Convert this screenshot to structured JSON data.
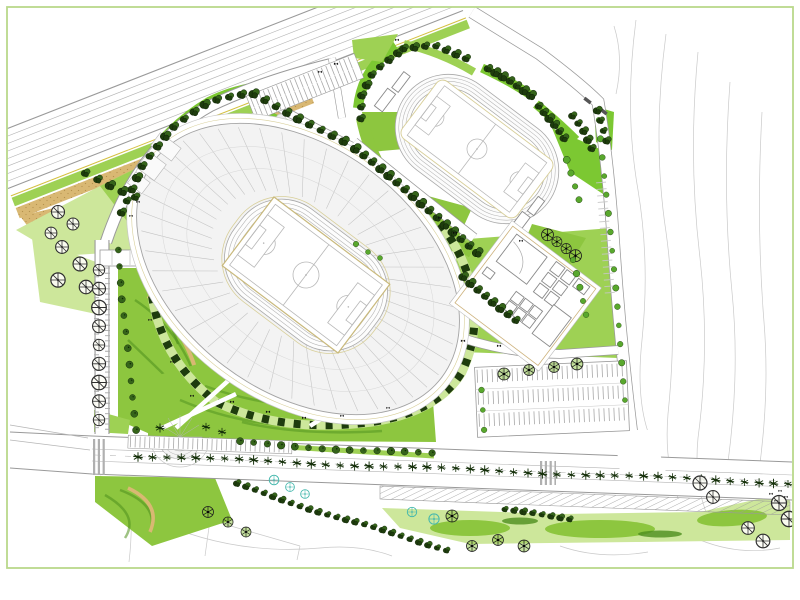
{
  "palette": {
    "paper": "#ffffff",
    "frame": "#b9d98b",
    "lawn_light": "#cde79b",
    "lawn_mid": "#9ed154",
    "lawn_bright": "#8dc63f",
    "lawn_vivid": "#7cc832",
    "grass_streak": "#4e8f1e",
    "tan": "#d9b873",
    "tan_dark": "#b5924e",
    "tan_line": "#d8cf9a",
    "road_edge": "#9a9a9a",
    "road_line": "#b5b5b5",
    "detail_gray": "#c7c7c7",
    "detail_faint": "#d6d6d6",
    "contour": "#c9c9c9",
    "stand_fill": "#f3f3f3",
    "pitch_border": "#c9b97c",
    "pitch_line": "#b8b8b8",
    "tree_dark": "#1e3c0d",
    "tree_mid": "#35641a",
    "tree_leaf": "#59a82d",
    "tree_cyan": "#45b8ad",
    "median_tree": "#15300a",
    "yellow_line": "#d4c040"
  },
  "stadium": {
    "center": [
      306,
      275
    ],
    "rotation": 37,
    "bowl_cx": -10,
    "sections": 44,
    "stand_inner": [
      96,
      66
    ],
    "stand_outer": [
      176,
      118
    ]
  },
  "track": {
    "center": [
      477,
      149
    ],
    "rotation": 37,
    "lanes": 6
  },
  "vegetation": {
    "rows": [
      {
        "name": "stadium-nw-road-trees",
        "type": "dark",
        "size": 4.4,
        "count": 24,
        "pts": [
          [
            122,
            212
          ],
          [
            142,
            164
          ],
          [
            172,
            128
          ],
          [
            210,
            102
          ],
          [
            252,
            92
          ],
          [
            300,
            118
          ],
          [
            344,
            141
          ]
        ]
      },
      {
        "name": "corridor-trees",
        "type": "dark",
        "size": 4.6,
        "count": 16,
        "pts": [
          [
            356,
            148
          ],
          [
            400,
            186
          ],
          [
            440,
            218
          ],
          [
            478,
            252
          ]
        ]
      },
      {
        "name": "track-nw-trees",
        "type": "dark",
        "size": 4.2,
        "count": 8,
        "pts": [
          [
            398,
            52
          ],
          [
            374,
            72
          ],
          [
            363,
            96
          ],
          [
            362,
            118
          ]
        ]
      },
      {
        "name": "track-n-trees",
        "type": "dark",
        "size": 4.1,
        "count": 7,
        "pts": [
          [
            404,
            47
          ],
          [
            434,
            45
          ],
          [
            466,
            59
          ]
        ]
      },
      {
        "name": "track-ne-trees",
        "type": "dark",
        "size": 4.5,
        "count": 7,
        "pts": [
          [
            488,
            69
          ],
          [
            510,
            80
          ],
          [
            532,
            94
          ]
        ]
      },
      {
        "name": "track-e-trees-1",
        "type": "dark",
        "size": 4.3,
        "count": 6,
        "pts": [
          [
            540,
            105
          ],
          [
            554,
            122
          ],
          [
            564,
            138
          ]
        ]
      },
      {
        "name": "track-e-trees-2",
        "type": "dark",
        "size": 4.1,
        "count": 5,
        "pts": [
          [
            572,
            116
          ],
          [
            584,
            132
          ],
          [
            592,
            148
          ]
        ]
      },
      {
        "name": "track-se-spoke-trees",
        "type": "spoke",
        "size": 5.5,
        "count": 4,
        "pts": [
          [
            548,
            234
          ],
          [
            562,
            244
          ],
          [
            576,
            255
          ]
        ]
      },
      {
        "name": "track-e-leaf-trees",
        "type": "leaf",
        "size": 4,
        "count": 4,
        "pts": [
          [
            566,
            160
          ],
          [
            572,
            180
          ],
          [
            578,
            200
          ]
        ]
      },
      {
        "name": "buildings-nw-trees",
        "type": "dark",
        "size": 4.4,
        "count": 8,
        "pts": [
          [
            464,
            276
          ],
          [
            490,
            298
          ],
          [
            516,
            320
          ]
        ]
      },
      {
        "name": "buildings-e-trees",
        "type": "leaf",
        "size": 3.8,
        "count": 5,
        "pts": [
          [
            573,
            260
          ],
          [
            585,
            315
          ]
        ]
      },
      {
        "name": "west-road-outline-trees",
        "type": "round",
        "size": 6.5,
        "count": 9,
        "jitter": 0,
        "pts": [
          [
            99,
            270
          ],
          [
            99,
            420
          ]
        ]
      },
      {
        "name": "west-road-inner-trees",
        "type": "mid",
        "size": 3.8,
        "count": 12,
        "pts": [
          [
            119,
            250
          ],
          [
            121,
            300
          ],
          [
            127,
            350
          ],
          [
            133,
            400
          ],
          [
            137,
            430
          ]
        ]
      },
      {
        "name": "boulevard-north-trees",
        "type": "mid",
        "size": 4,
        "count": 15,
        "pts": [
          [
            240,
            442
          ],
          [
            340,
            449
          ],
          [
            432,
            454
          ]
        ]
      },
      {
        "name": "boulevard-median-trees",
        "type": "spiky",
        "size": 4.3,
        "count": 46,
        "pts": [
          [
            138,
            456
          ],
          [
            788,
            483
          ]
        ]
      },
      {
        "name": "south-diagonal-trees",
        "type": "dark",
        "size": 3.4,
        "count": 24,
        "pts": [
          [
            237,
            484
          ],
          [
            340,
            518
          ],
          [
            447,
            549
          ]
        ]
      },
      {
        "name": "east-road-trees",
        "type": "leaf",
        "size": 3.6,
        "count": 16,
        "pts": [
          [
            600,
            120
          ],
          [
            612,
            260
          ],
          [
            626,
            400
          ]
        ]
      },
      {
        "name": "bottom-band-trees",
        "type": "dark",
        "size": 3.4,
        "count": 8,
        "pts": [
          [
            505,
            510
          ],
          [
            570,
            518
          ]
        ]
      },
      {
        "name": "tan-walk-trees",
        "type": "dark",
        "size": 4.5,
        "count": 5,
        "pts": [
          [
            86,
            172
          ],
          [
            136,
            196
          ]
        ]
      },
      {
        "name": "parking-edge-trees",
        "type": "leaf",
        "size": 3.6,
        "count": 3,
        "pts": [
          [
            481,
            390
          ],
          [
            483,
            430
          ]
        ]
      },
      {
        "name": "east-wedge-trees",
        "type": "dark",
        "size": 3.8,
        "count": 4,
        "pts": [
          [
            598,
            110
          ],
          [
            608,
            140
          ]
        ]
      }
    ],
    "scatter": [
      {
        "name": "nw-outline-trees",
        "type": "round",
        "size": 6.5,
        "pts": [
          [
            58,
            212
          ],
          [
            73,
            224
          ],
          [
            51,
            233
          ],
          [
            62,
            247
          ],
          [
            80,
            264
          ],
          [
            58,
            280
          ],
          [
            86,
            287
          ]
        ]
      },
      {
        "name": "plaza-trees",
        "type": "spiky",
        "size": 4.5,
        "pts": [
          [
            160,
            428
          ],
          [
            206,
            427
          ],
          [
            222,
            432
          ]
        ]
      },
      {
        "name": "sw-spoke-trees",
        "type": "spoke",
        "size": 5.5,
        "pts": [
          [
            208,
            512
          ],
          [
            228,
            522
          ],
          [
            246,
            532
          ]
        ]
      },
      {
        "name": "cyan-trees",
        "type": "cyan",
        "size": 5,
        "pts": [
          [
            274,
            480
          ],
          [
            290,
            487
          ],
          [
            305,
            494
          ],
          [
            412,
            512
          ],
          [
            434,
            519
          ]
        ]
      },
      {
        "name": "bottom-spoke-trees",
        "type": "spoke",
        "size": 6,
        "pts": [
          [
            452,
            516
          ],
          [
            472,
            546
          ],
          [
            498,
            540
          ],
          [
            524,
            546
          ]
        ]
      },
      {
        "name": "se-outline-trees",
        "type": "round",
        "size": 7,
        "pts": [
          [
            700,
            483
          ],
          [
            713,
            497
          ],
          [
            748,
            528
          ],
          [
            763,
            541
          ],
          [
            779,
            503
          ],
          [
            789,
            519
          ]
        ]
      },
      {
        "name": "se-shrubs",
        "type": "shrub",
        "size": 2.6,
        "pts": [
          [
            771,
            494
          ],
          [
            780,
            491
          ],
          [
            776,
            501
          ],
          [
            786,
            497
          ]
        ]
      },
      {
        "name": "parking-row-trees",
        "type": "spoke",
        "size": 6,
        "pts": [
          [
            504,
            374
          ],
          [
            529,
            370
          ],
          [
            554,
            367
          ],
          [
            577,
            364
          ]
        ]
      },
      {
        "name": "lawn-shrubs",
        "type": "shrub",
        "size": 2.8,
        "pts": [
          [
            397,
            40
          ],
          [
            150,
            320
          ],
          [
            172,
            362
          ],
          [
            192,
            396
          ],
          [
            232,
            402
          ],
          [
            268,
            412
          ],
          [
            304,
            418
          ],
          [
            342,
            416
          ],
          [
            388,
            408
          ],
          [
            440,
            218
          ],
          [
            455,
            233
          ],
          [
            463,
            341
          ],
          [
            499,
            346
          ],
          [
            521,
            241
          ],
          [
            138,
            202
          ],
          [
            131,
            216
          ],
          [
            320,
            72
          ],
          [
            336,
            64
          ]
        ]
      },
      {
        "name": "track-sw-lawn-trees",
        "type": "leaf",
        "size": 3.5,
        "pts": [
          [
            356,
            244
          ],
          [
            368,
            252
          ],
          [
            380,
            258
          ]
        ]
      }
    ]
  }
}
